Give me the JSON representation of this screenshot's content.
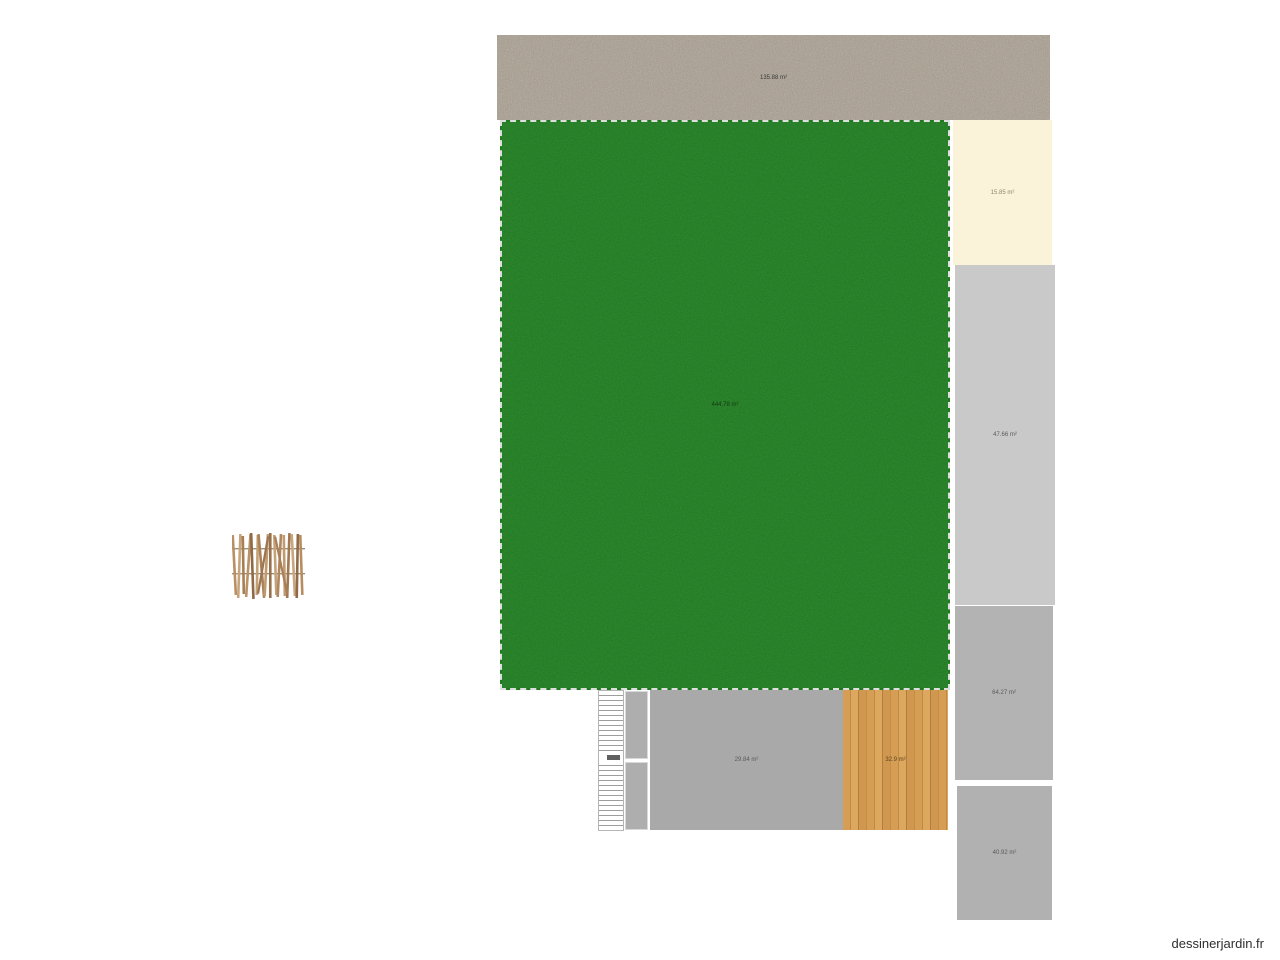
{
  "watermark": "dessinerjardin.fr",
  "areas": {
    "gravel": {
      "label": "135.88 m²",
      "color": "#a89d8d",
      "type": "gravel-path"
    },
    "lawn": {
      "label": "444.78 m²",
      "color": "#1e7c1f",
      "type": "lawn"
    },
    "cream": {
      "label": "15.85 m²",
      "color": "#faf3da",
      "type": "paved-zone"
    },
    "gray_tall": {
      "label": "47.66 m²",
      "color": "#c9c9c9",
      "type": "concrete-zone"
    },
    "gray_mid": {
      "label": "64.27 m²",
      "color": "#b3b3b3",
      "type": "concrete-zone"
    },
    "gray_bottom": {
      "label": "40.92 m²",
      "color": "#b1b1b1",
      "type": "concrete-zone"
    },
    "gray_center": {
      "label": "29.84 m²",
      "color": "#a9a9a9",
      "type": "terrace-zone"
    },
    "deck": {
      "label": "32.9 m²",
      "color": "#d69e54",
      "type": "wood-deck"
    }
  },
  "objects": {
    "staircase": "double-flight-staircase",
    "fence": "wooden-picket-fence"
  }
}
